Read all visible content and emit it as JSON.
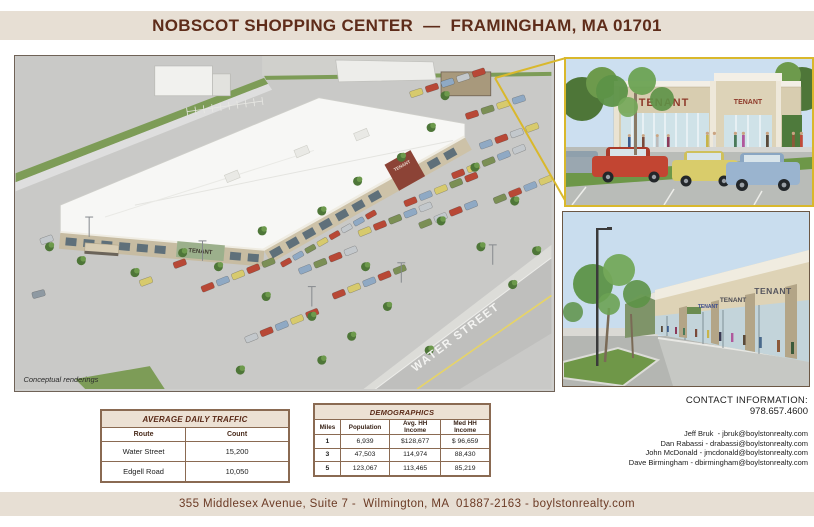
{
  "header": {
    "title": "NOBSCOT SHOPPING CENTER  —  FRAMINGHAM, MA 01701"
  },
  "main_rendering": {
    "street_label": "WATER STREET",
    "tenant_sign": "TENANT",
    "note": "Conceptual renderings"
  },
  "detail_renderings": {
    "closeup": {
      "sign_large": "TENANT",
      "sign_small": "TENANT"
    },
    "street_view": {
      "sign_1": "TENANT",
      "sign_2": "TENANT",
      "sign_3": "TENANT"
    }
  },
  "contact": {
    "heading": "CONTACT INFORMATION:",
    "phone": "978.657.4600",
    "agents": [
      "Jeff Bruk  - jbruk@boylstonrealty.com",
      "Dan Rabassi - drabassi@boylstonrealty.com",
      "John McDonald - jmcdonald@boylstonrealty.com",
      "Dave Birmingham - dbirmingham@boylstonrealty.com"
    ]
  },
  "traffic_table": {
    "title": "AVERAGE DAILY TRAFFIC",
    "columns": [
      "Route",
      "Count"
    ],
    "rows": [
      [
        "Water Street",
        "15,200"
      ],
      [
        "Edgell Road",
        "10,050"
      ]
    ]
  },
  "demographics_table": {
    "title": "DEMOGRAPHICS",
    "columns": [
      "Miles",
      "Population",
      "Avg. HH Income",
      "Med HH Income"
    ],
    "rows": [
      [
        "1",
        "6,939",
        "$128,677",
        "$ 96,659"
      ],
      [
        "3",
        "47,503",
        "114,974",
        "88,430"
      ],
      [
        "5",
        "123,067",
        "113,465",
        "85,219"
      ]
    ]
  },
  "footer": {
    "address": "355 Middlesex Avenue, Suite 7 -  Wilmington, MA  01887-2163 - boylstonrealty.com"
  },
  "colors": {
    "banner_bg": "#e7dfd4",
    "title_text": "#5e2c1a",
    "table_border": "#8a6a52",
    "table_header_bg": "#ece1d4",
    "callout_yellow": "#d9b82c",
    "grass_green": "#7d9c57",
    "asphalt_gray": "#c9c9c7"
  }
}
